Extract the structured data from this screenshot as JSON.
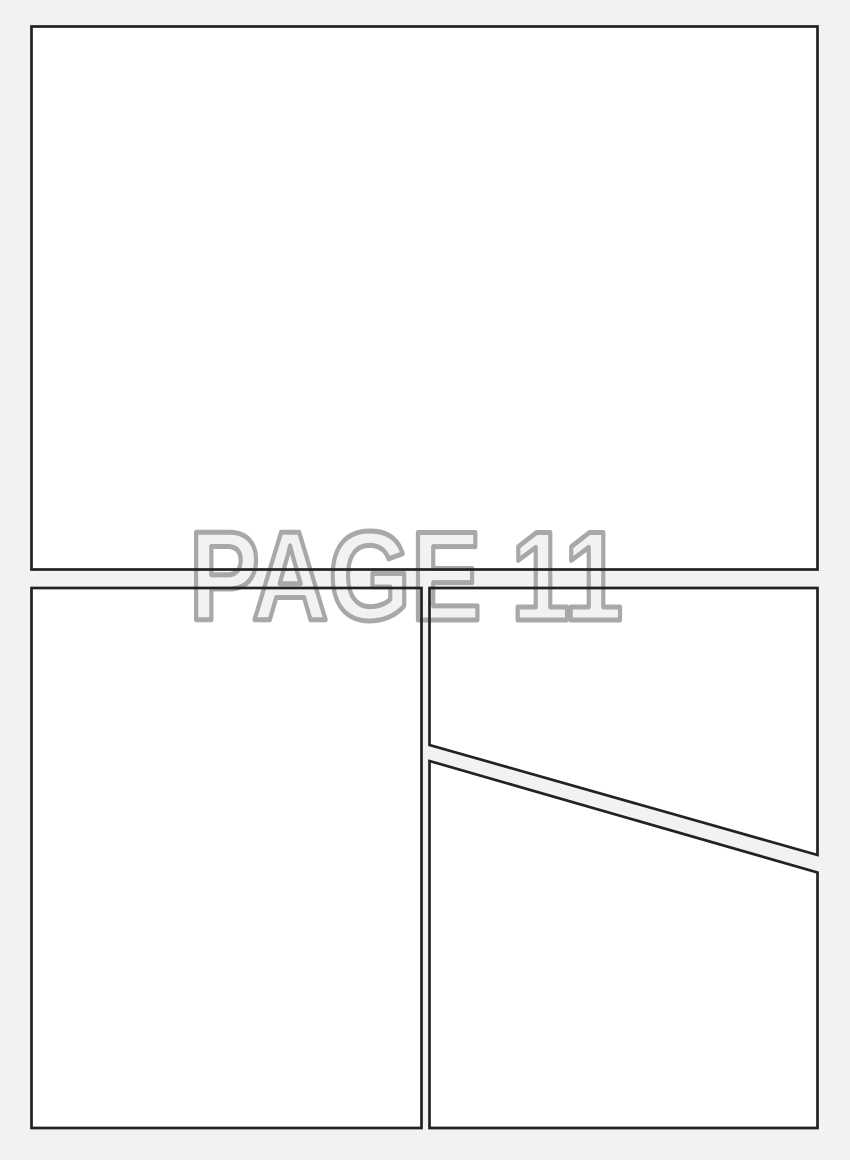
{
  "overlay": {
    "label": "PAGE 11"
  },
  "colors": {
    "background": "#f2f2f2",
    "panel_fill": "#ffffff",
    "panel_border": "#222222",
    "label_outline": "#a8a8a8",
    "label_fill": "#f2f2f2"
  },
  "panels": {
    "count": 4,
    "names": [
      "top-full-width-panel",
      "bottom-left-panel",
      "bottom-right-upper-panel",
      "bottom-right-lower-panel"
    ]
  }
}
